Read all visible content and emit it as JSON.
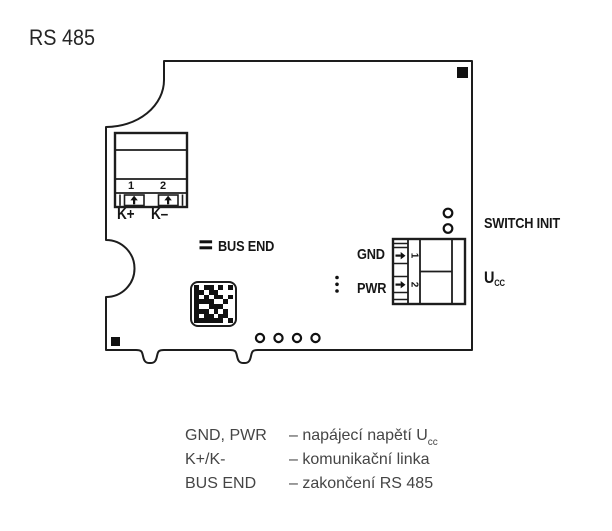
{
  "title": "RS 485",
  "colors": {
    "ink": "#1d1d1d",
    "legend_text": "#454545"
  },
  "board": {
    "k_block": {
      "pin1": "1",
      "pin2": "2",
      "kplus_label": "K+",
      "kminus_label": "K–"
    },
    "bus_end_label": "BUS END",
    "gnd_label": "GND",
    "pwr_label": "PWR",
    "switch_init_label": "SWITCH INIT",
    "ucc_label": "U",
    "ucc_sub": "CC",
    "gnd_pwr_block": {
      "pin1": "1",
      "pin2": "2"
    },
    "datamatrix": {
      "rows": [
        "10110101",
        "11011000",
        "10101101",
        "11110010",
        "10011100",
        "11101010",
        "10110110",
        "11111101"
      ]
    }
  },
  "legend": {
    "rows": [
      {
        "term": "GND, PWR",
        "desc": "– napájecí napětí U",
        "desc_sub": "cc"
      },
      {
        "term": "K+/K-",
        "desc": "– komunikační linka",
        "desc_sub": ""
      },
      {
        "term": "BUS END",
        "desc": "– zakončení RS 485",
        "desc_sub": ""
      }
    ]
  }
}
